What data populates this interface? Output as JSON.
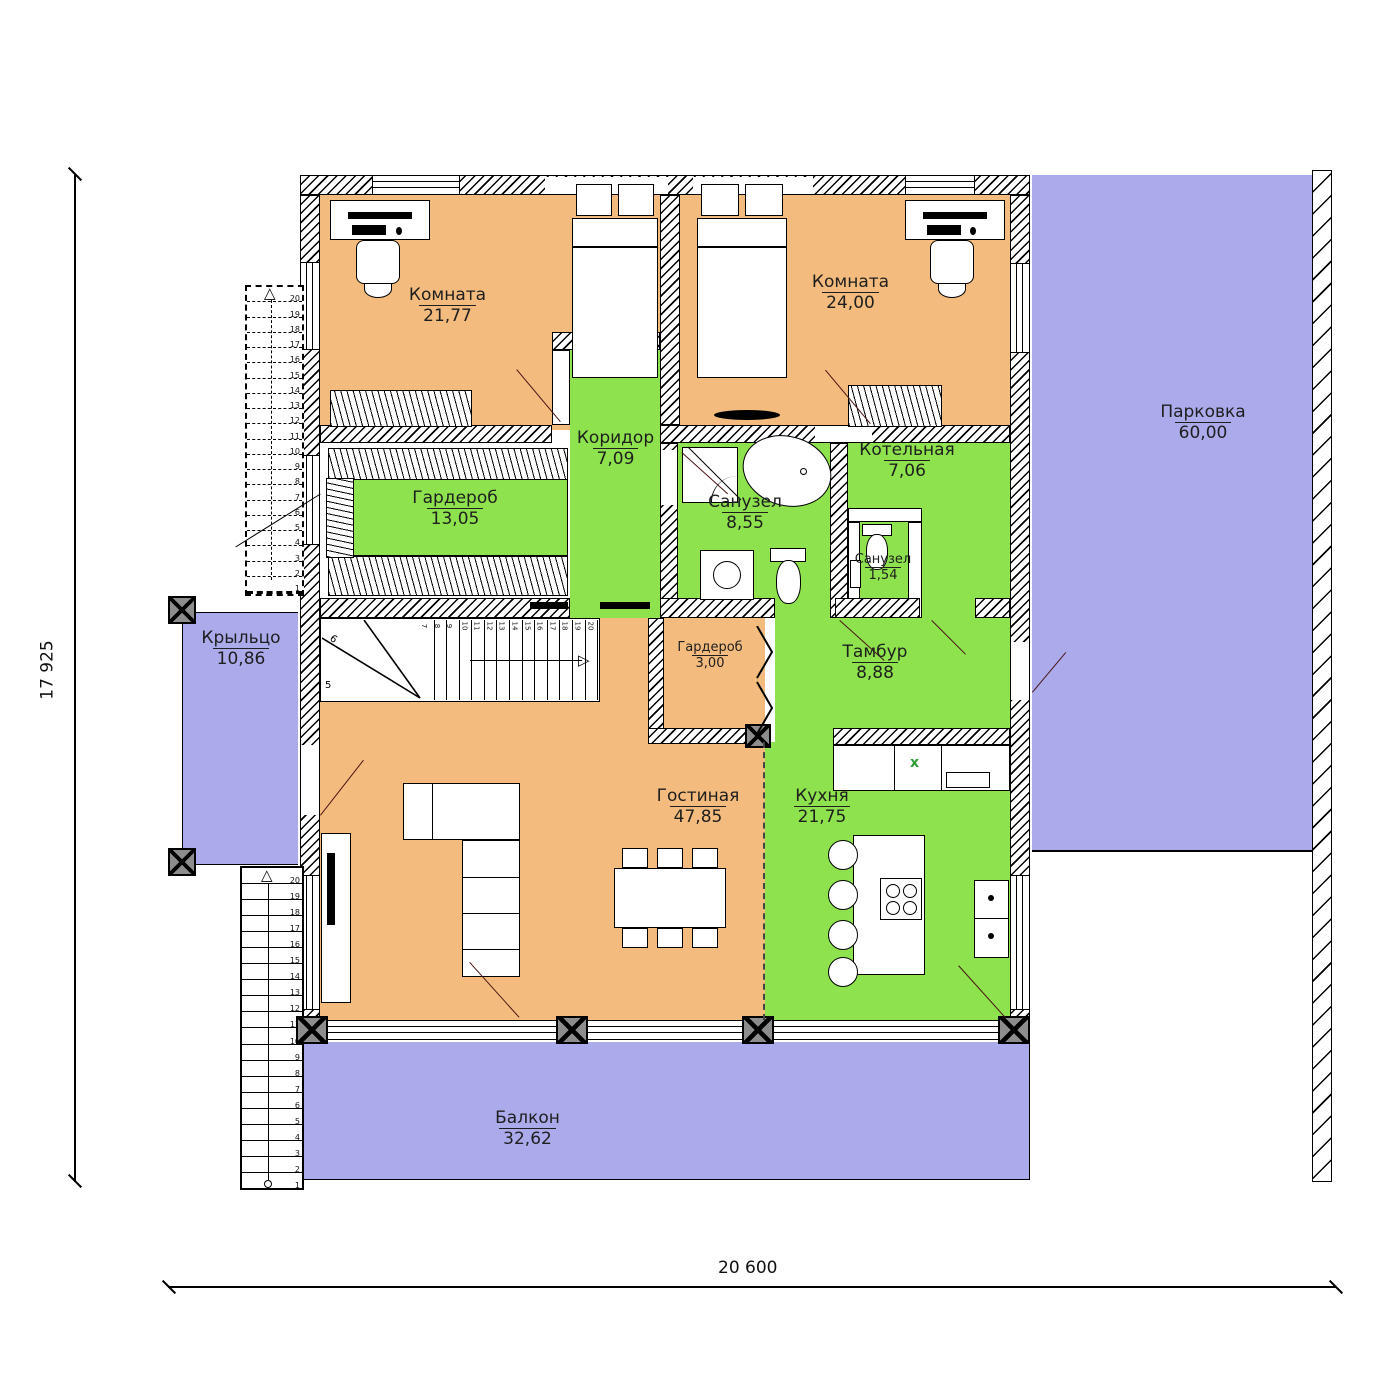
{
  "colors": {
    "room_warm": "#F3BC7E",
    "room_utility": "#8DE24D",
    "outdoor": "#ABABEC",
    "wall_line": "#000000",
    "door_leaf": "#4a1414",
    "sink_mark_green": "#2e9e38"
  },
  "dimensions": {
    "height_label": "17 925",
    "width_label": "20 600"
  },
  "rooms": {
    "bedroom1": {
      "name": "Комната",
      "area": "21,77"
    },
    "bedroom2": {
      "name": "Комната",
      "area": "24,00"
    },
    "corridor": {
      "name": "Коридор",
      "area": "7,09"
    },
    "wardrobe_main": {
      "name": "Гардероб",
      "area": "13,05"
    },
    "bathroom": {
      "name": "Санузел",
      "area": "8,55"
    },
    "boiler": {
      "name": "Котельная",
      "area": "7,06"
    },
    "wc": {
      "name": "Санузел",
      "area": "1,54"
    },
    "porch": {
      "name": "Крыльцо",
      "area": "10,86"
    },
    "wardrobe_small": {
      "name": "Гардероб",
      "area": "3,00"
    },
    "tambour": {
      "name": "Тамбур",
      "area": "8,88"
    },
    "living": {
      "name": "Гостиная",
      "area": "47,85"
    },
    "kitchen": {
      "name": "Кухня",
      "area": "21,75"
    },
    "balcony": {
      "name": "Балкон",
      "area": "32,62"
    },
    "parking": {
      "name": "Парковка",
      "area": "60,00"
    }
  },
  "stairs": {
    "exterior_upper": {
      "steps": 20
    },
    "exterior_lower": {
      "steps": 20
    },
    "interior": {
      "run": {
        "from": 7,
        "to": 20
      },
      "winder_labels": {
        "five": "5",
        "six": "6"
      }
    }
  },
  "kitchen_details": {
    "sink_mark": "x"
  }
}
